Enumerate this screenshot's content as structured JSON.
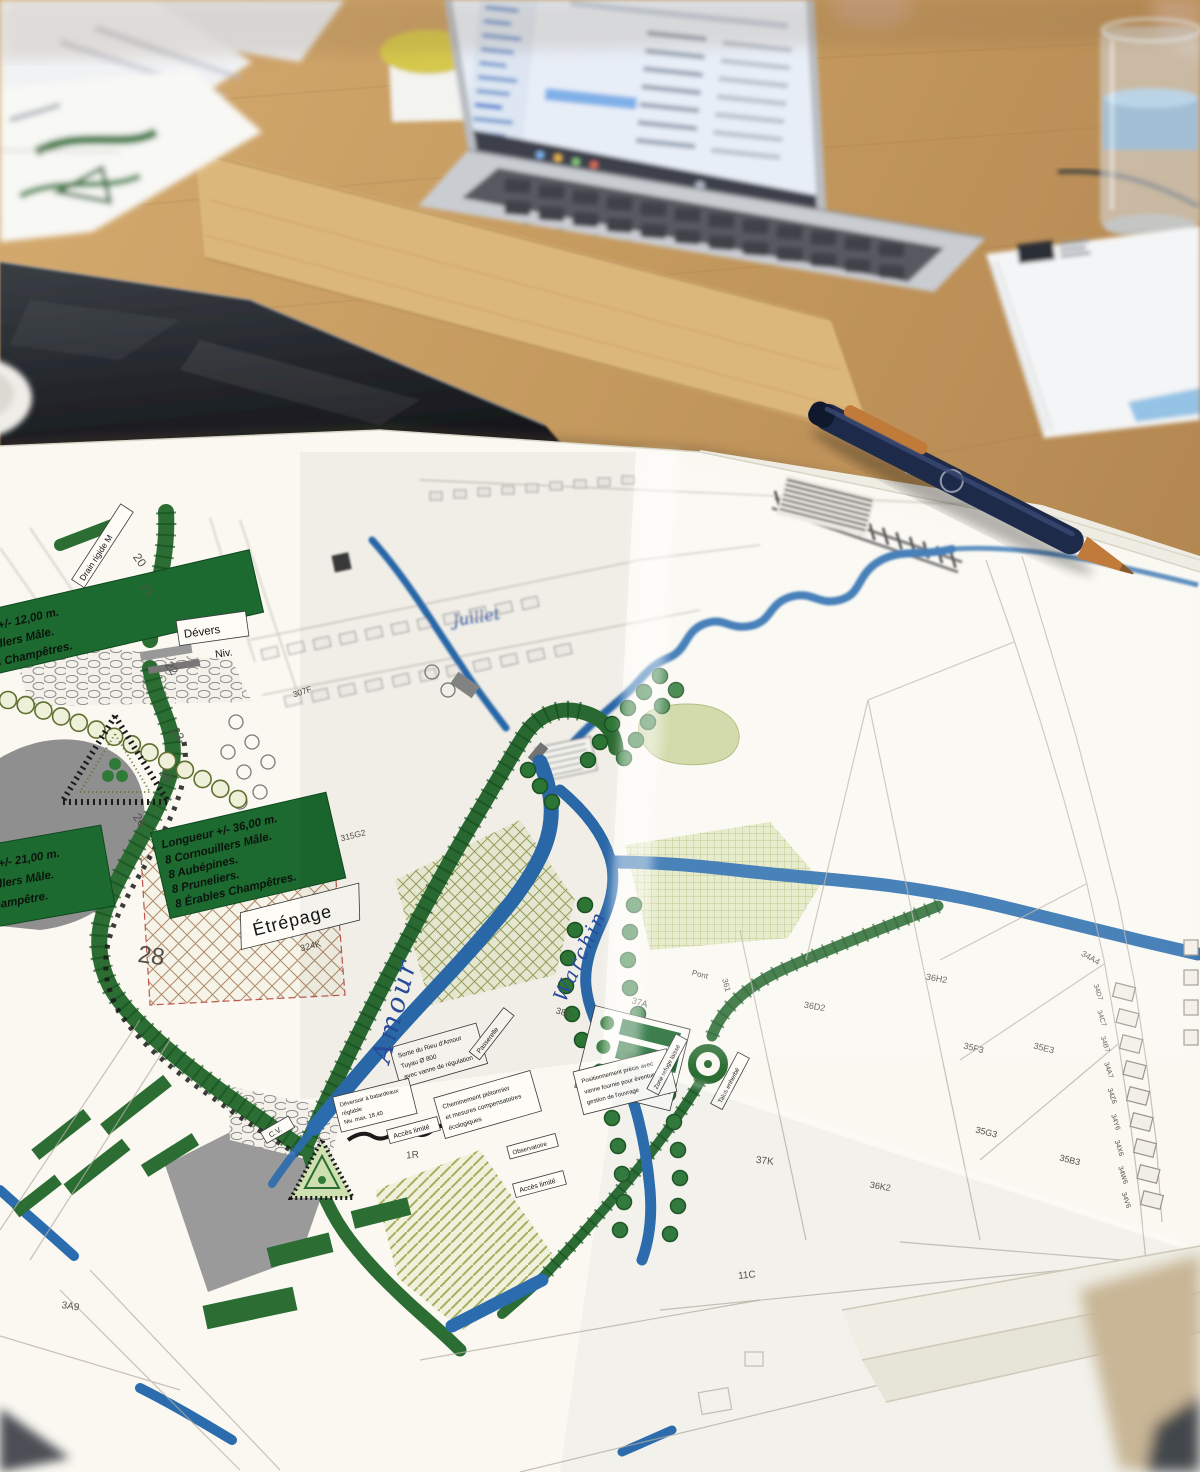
{
  "colors": {
    "wood": "#c59a5f",
    "glass_table": "#26292e",
    "paper": "#f8f5ee",
    "map_green": "#2b6d33",
    "map_blue": "#2b6cae",
    "hatch_green": "#9aa45e",
    "ink_blue": "#2a4fa0",
    "pen_navy": "#1d2a4a",
    "pen_copper": "#c07a3a",
    "notepad_stripe": "#8fc0e4"
  },
  "plan": {
    "green_label_main": {
      "l1": "Longueur +/- 36,00 m.",
      "l2": "8 Cornouillers Mâle.",
      "l3": "8 Aubépines.",
      "l4": "8 Pruneliers.",
      "l5": "8 Érables Champêtres."
    },
    "green_label_topleft": {
      "l1": "Longueur +/- 12,00 m.",
      "l2": "8 Cornouillers Mâle.",
      "l3": "8 Érables Champêtres."
    },
    "green_label_left": {
      "l1": "Longueur +/- 21,00 m.",
      "l2": "8 Cornouillers Mâle.",
      "l3": "Érable champêtre."
    },
    "labels": {
      "etrepage": "Étrépage",
      "devers": "Dévers",
      "niv": "Niv.",
      "drain": "Drain rigide M",
      "sortie1": "Sortie du Rieu d'Amour",
      "sortie2": "Tuyau Ø 800",
      "sortie3": "avec vanne de régulation",
      "chem1": "Cheminement piétonnier",
      "chem2": "et mesures compensatoires",
      "chem3": "écologiques",
      "dever1": "Déversoir à batardeaux",
      "dever2": "réglable",
      "dever3": "Niv. max. 18,40",
      "acces": "Accès limité",
      "passerelle": "Passerelle",
      "observatoire": "Observatoire",
      "pos1": "Positionnement précis avec",
      "pos2": "vanne fournie pour éventuelle",
      "pos3": "gestion de l'ouvrage",
      "zone_refuge": "Zone refuge laissé",
      "talus": "Talus enherbé",
      "cv": "C.V.",
      "pont": "Pont"
    },
    "handwritten": {
      "amour": "Amour",
      "warchin": "Warchin",
      "juillet": "Juillet"
    },
    "parcels": {
      "p28": "28",
      "p1r": "1R",
      "p37a": "37A",
      "p38c": "38C",
      "p37k": "37K",
      "p11c": "11C",
      "p307f": "307F",
      "p315g2": "315G2",
      "p324k": "324K",
      "p3a9": "3A9",
      "p35f3": "35F3",
      "p35e3": "35E3",
      "p35g3": "35G3",
      "p35b3": "35B3",
      "p34a4": "34A4",
      "p36d2": "36D2",
      "p36h2": "36H2",
      "p36k2": "36K2",
      "p361": "361",
      "houses": [
        "34D7",
        "34C7",
        "34B7",
        "34A7",
        "34Z6",
        "34Y6",
        "34X6",
        "34W6",
        "34V6"
      ]
    },
    "chainage": {
      "c20": "20",
      "c21": "21",
      "c22": "22",
      "c23": "23",
      "c25": "25",
      "c26": "26"
    }
  }
}
